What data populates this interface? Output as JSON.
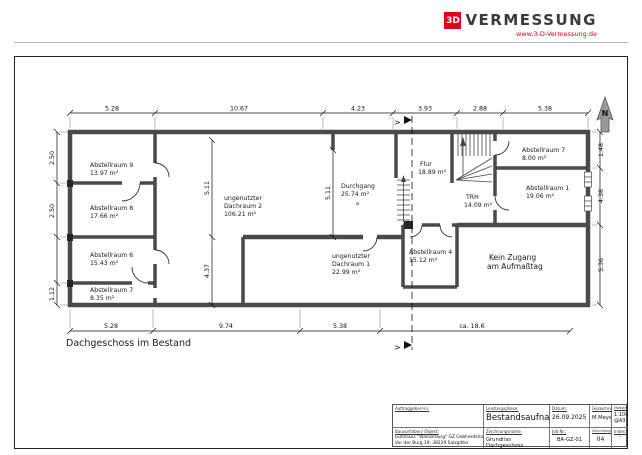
{
  "header": {
    "logo_mark": "3D",
    "logo_name": "VERMESSUNG",
    "logo_url": "www.3-D-Vermessung.de",
    "brand_red": "#e2001a"
  },
  "plan": {
    "title": "Dachgeschoss im Bestand",
    "north_label": "N",
    "annotation_a": "a",
    "rooms": {
      "a9": {
        "name": "Abstellraum 9",
        "area": "13.97 m²"
      },
      "a8": {
        "name": "Abstellraum 8",
        "area": "17.66 m²"
      },
      "a6": {
        "name": "Abstellraum 6",
        "area": "15.43 m²"
      },
      "a7_left": {
        "name": "Abstellraum 7",
        "area": "8.35 m²"
      },
      "dachraum2": {
        "name1": "ungenutzter",
        "name2": "Dachraum 2",
        "area": "106.21 m²"
      },
      "durchgang": {
        "name": "Durchgang",
        "area": "25.74 m²"
      },
      "flur": {
        "name": "Flur",
        "area": "18.89 m²"
      },
      "trh": {
        "name": "TRH",
        "area": "14.09 m²"
      },
      "a7_right": {
        "name": "Abstellraum 7",
        "area": "8.00 m²"
      },
      "a1": {
        "name": "Abstellraum 1",
        "area": "19.06 m²"
      },
      "a4": {
        "name": "Abstellraum 4",
        "area": "15.12 m²"
      },
      "dachraum1": {
        "name1": "ungenutzter",
        "name2": "Dachraum 1",
        "area": "22.99 m²"
      }
    },
    "note": {
      "line1": "Kein Zugang",
      "line2": "am Aufmaßtag"
    }
  },
  "dims": {
    "top": [
      "5.28",
      "10.67",
      "4.23",
      "3.93",
      "2.88",
      "5.38"
    ],
    "bottom": [
      "5.28",
      "9.74",
      "5.38",
      "ca. 18.6"
    ],
    "left": [
      "2.50",
      "2.50",
      "1.12"
    ],
    "right": [
      "1.48",
      "4.38",
      "5.36"
    ],
    "inner": [
      "5.11",
      "4.37",
      "5.11"
    ]
  },
  "titleblock": {
    "client_label": "Auftraggeber/-in:",
    "phase_label": "Leistungsphase:",
    "phase_value": "Bestandsaufnahme",
    "date_label": "Datum:",
    "date_value": "26.09.2025",
    "drawn_label": "Gezeichnet:",
    "drawn_value": "M.Meyer",
    "scale_label": "Maßstab:",
    "scale_value": "1:100",
    "scale_sheet": "@A3",
    "project_label": "Bauvorhaben/ Objekt:",
    "project_line1": "Gutshaus \"Wasserburg\" GZ Gebhardshagen",
    "project_line2": "Vor der Burg 19, 38229 Salzgitter",
    "drawing_label": "Zeichnungsname:",
    "drawing_value": "Grundriss Dachgeschoss",
    "job_label": "Job Nr.:",
    "job_value": "BA-GZ-01",
    "number_label": "Zeichnungs-Nr.:",
    "number_value": "04",
    "index_label": "Index:",
    "index_value": "-"
  }
}
